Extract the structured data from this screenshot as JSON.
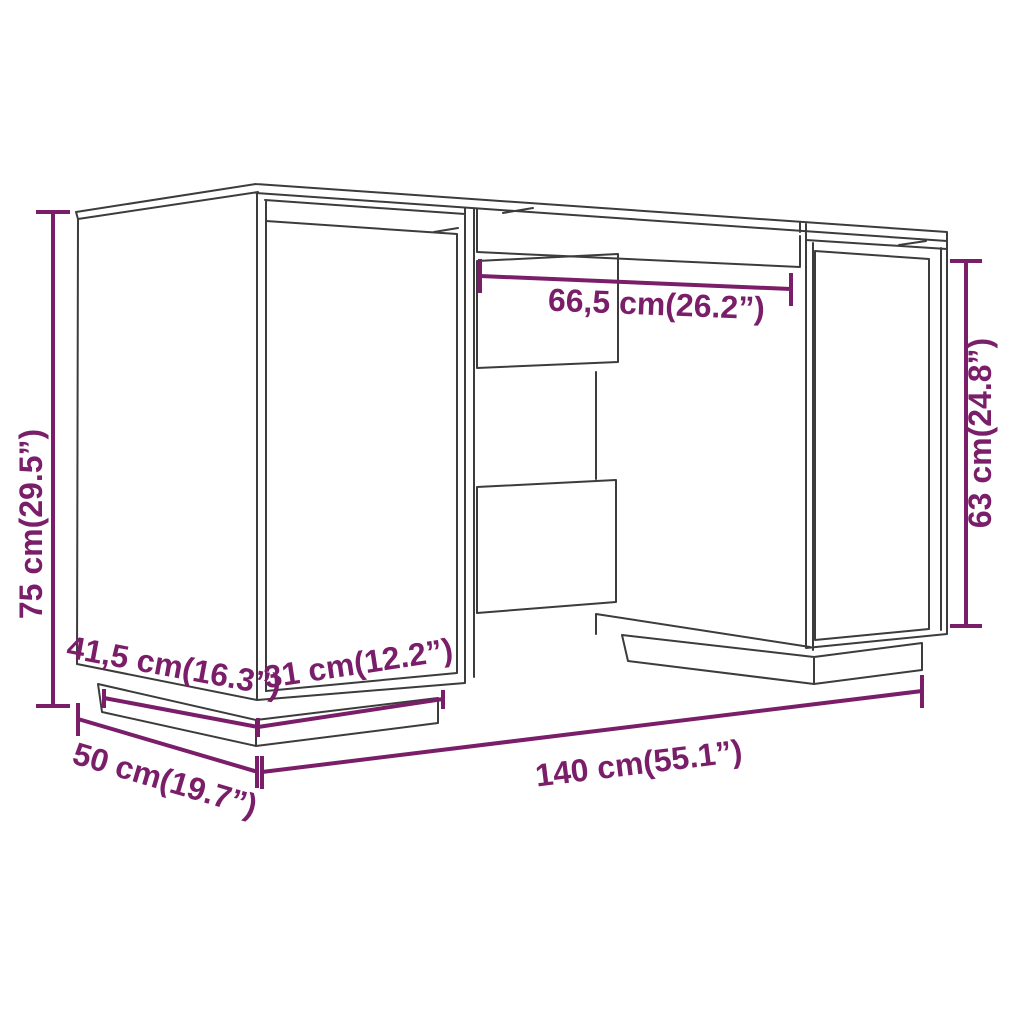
{
  "diagram": {
    "kind": "product-dimension-diagram",
    "subject": "desk"
  },
  "colors": {
    "outline": "#3c3c3c",
    "dimension": "#7a1e69",
    "background": "#ffffff"
  },
  "labels": {
    "height": "75 cm(29.5”)",
    "top_clearance_width": "66,5 cm(26.2”)",
    "cabinet_height": "63 cm(24.8”)",
    "base_depth": "41,5 cm(16.3”)",
    "base_width": "31 cm(12.2”)",
    "total_width": "140 cm(55.1”)",
    "total_depth": "50 cm(19.7”)"
  }
}
